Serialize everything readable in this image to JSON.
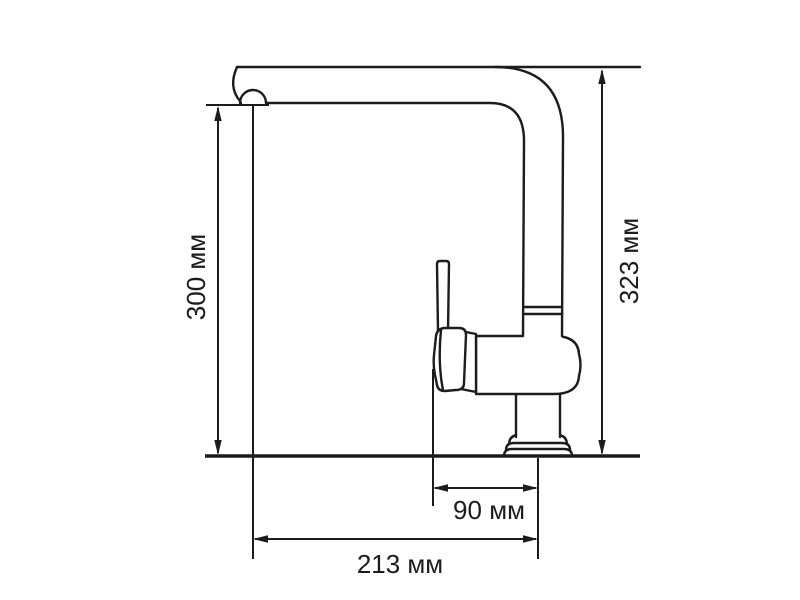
{
  "diagram": {
    "type": "technical-dimension-drawing",
    "subject": "kitchen-faucet-side-view",
    "unit": "мм",
    "colors": {
      "line": "#1c1c1c",
      "background": "#ffffff"
    },
    "dimensions": [
      {
        "id": "spout-height",
        "label": "300 мм",
        "value": 300,
        "orientation": "vertical"
      },
      {
        "id": "overall-height",
        "label": "323 мм",
        "value": 323,
        "orientation": "vertical"
      },
      {
        "id": "base-offset",
        "label": "90 мм",
        "value": 90,
        "orientation": "horizontal"
      },
      {
        "id": "spout-reach",
        "label": "213 мм",
        "value": 213,
        "orientation": "horizontal"
      }
    ]
  }
}
